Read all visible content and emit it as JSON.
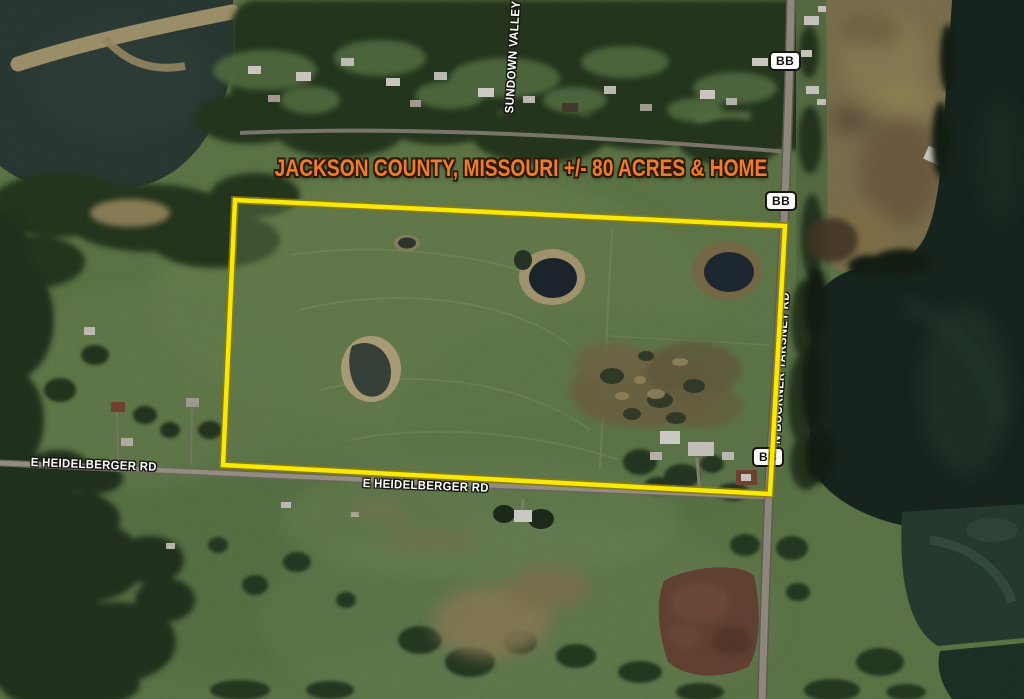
{
  "map": {
    "title": "JACKSON COUNTY, MISSOURI +/- 80 ACRES & HOME",
    "labels": {
      "heidelberger_west": "E HEIDELBERGER RD",
      "heidelberger_east": "E HEIDELBERGER RD",
      "buckner_tarsney": "N BUCKNER TARSNEY RD",
      "sundown_valley": "SUNDOWN VALLEY"
    },
    "route_markers": [
      {
        "label": "BB"
      },
      {
        "label": "BB"
      },
      {
        "label": "BB"
      }
    ],
    "colors": {
      "title_text": "#ee7c2f",
      "boundary_line": "#f8ea06",
      "road_label_text": "#ffffff",
      "route_marker_bg": "#fbfbf9",
      "route_marker_text": "#111111"
    }
  }
}
